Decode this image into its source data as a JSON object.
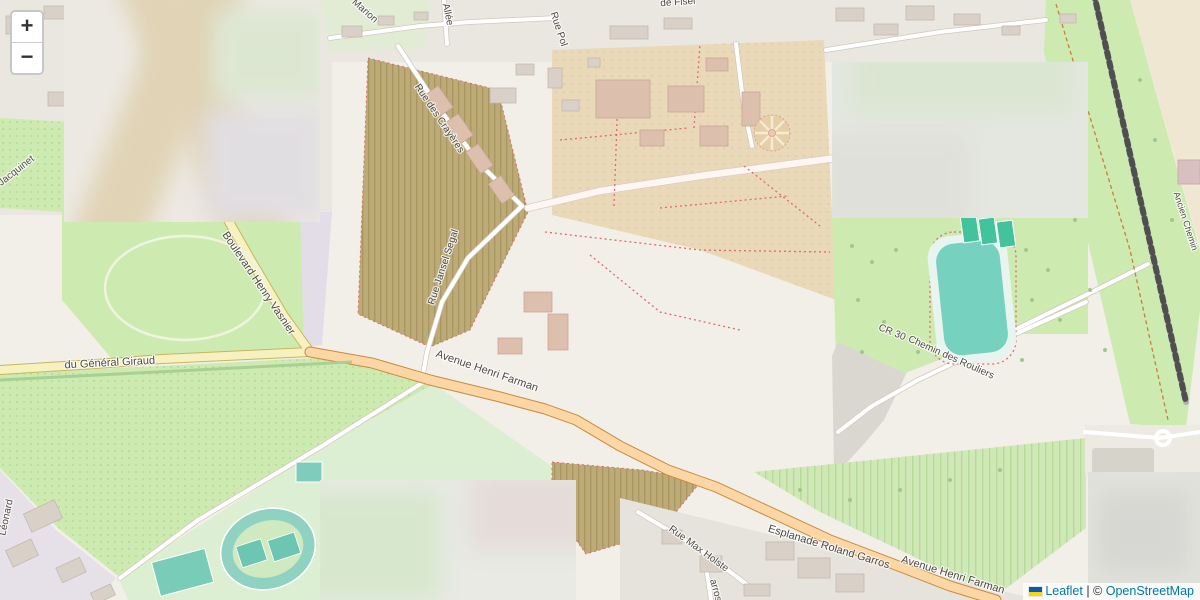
{
  "controls": {
    "zoom_in": "+",
    "zoom_out": "−"
  },
  "attribution": {
    "leaflet": "Leaflet",
    "separator": " | ",
    "copyright_prefix": "©",
    "osm": "OpenStreetMap"
  },
  "colors": {
    "street_label": "#4e4a43",
    "parking": "#3069c9",
    "boundary": "#2e4a8f",
    "water": "#76d2bf",
    "park_green": "#cdebb0",
    "road_primary": "#fcd6a4",
    "road_secondary": "#f7f1c0"
  },
  "overlay": {
    "points": "368,57 822,40 840,428 590,558 357,312",
    "fill": "#f0414f",
    "fill_opacity": 0.28,
    "stroke": "#6b3049",
    "stroke_width": 2
  },
  "boundaries": [
    {
      "points": "355,0 367,57"
    },
    {
      "points": "0,177 118,366 357,312"
    },
    {
      "points": "1199,8 1139,234 1200,255"
    }
  ],
  "map": {
    "street_labels": [
      {
        "text": "Marion",
        "x": 363,
        "y": 13,
        "rot": 42,
        "size": 10
      },
      {
        "text": "Allée",
        "x": 445,
        "y": 15,
        "rot": 78,
        "size": 10
      },
      {
        "text": "de Fisel",
        "x": 678,
        "y": 5,
        "rot": -4,
        "size": 10
      },
      {
        "text": "Rue Pol",
        "x": 556,
        "y": 30,
        "rot": 72,
        "size": 10
      },
      {
        "text": "Rue des Crayères",
        "x": 437,
        "y": 120,
        "rot": 56,
        "size": 10
      },
      {
        "text": "Rue Jansel Segal",
        "x": 446,
        "y": 268,
        "rot": -72,
        "size": 10
      },
      {
        "text": "Boulevard Henry Vasnier",
        "x": 256,
        "y": 285,
        "rot": 56,
        "size": 11
      },
      {
        "text": "du Général Giraud",
        "x": 110,
        "y": 366,
        "rot": -3,
        "size": 11
      },
      {
        "text": "Avenue Henri Farman",
        "x": 486,
        "y": 374,
        "rot": 19,
        "size": 11
      },
      {
        "text": "Esplanade Roland Garros",
        "x": 828,
        "y": 550,
        "rot": 17,
        "size": 11
      },
      {
        "text": "Avenue Henri Farman",
        "x": 952,
        "y": 578,
        "rot": 17,
        "size": 11
      },
      {
        "text": "Rue Max Holste",
        "x": 697,
        "y": 551,
        "rot": 36,
        "size": 10
      },
      {
        "text": "arros",
        "x": 713,
        "y": 591,
        "rot": 75,
        "size": 10
      },
      {
        "text": "Chemin des Rouliers",
        "x": 950,
        "y": 360,
        "rot": 24,
        "size": 10
      },
      {
        "text": "CR 30",
        "x": 891,
        "y": 335,
        "rot": 22,
        "size": 10
      },
      {
        "text": "Ancien Chemin",
        "x": 1183,
        "y": 222,
        "rot": 72,
        "size": 9
      },
      {
        "text": "Jacquinet",
        "x": 18,
        "y": 173,
        "rot": -38,
        "size": 10
      },
      {
        "text": "Léonard",
        "x": 9,
        "y": 518,
        "rot": -78,
        "size": 10
      }
    ],
    "place_labels": [
      {
        "lines": [
          "Parc des",
          "Crayères"
        ],
        "x": 127,
        "y": 272,
        "lh": 15,
        "color": "#5e7f5e",
        "italic": true,
        "size": 12
      },
      {
        "lines": [
          "Château",
          "des Crayères"
        ],
        "x": 215,
        "y": 348,
        "lh": 11,
        "color": "#8a684a",
        "italic": false,
        "size": 10
      },
      {
        "lines": [
          "Résidence",
          "Moulin",
          "de la Housse"
        ],
        "x": 440,
        "y": 72,
        "lh": 11.5,
        "color": "#5d5450",
        "italic": false,
        "size": 10
      },
      {
        "lines": [
          "Monument",
          "aux Sportifs",
          "Rémois"
        ],
        "x": 475,
        "y": 403,
        "lh": 13,
        "color": "#7b4a35",
        "italic": false,
        "size": 11
      },
      {
        "lines": [
          "Monument",
          "de guerre"
        ],
        "x": 503,
        "y": 461,
        "lh": 13,
        "color": "#7b4a35",
        "italic": false,
        "size": 11
      },
      {
        "lines": [
          "Aire de",
          "Grand",
          "Passage",
          "des Gens",
          "du Voyage",
          "du Moulin",
          "de la Housse"
        ],
        "x": 876,
        "y": 371,
        "lh": 16.5,
        "color": "#848484",
        "italic": true,
        "size": 11
      },
      {
        "lines": [
          "Centre",
          "en Route",
          "de la"
        ],
        "x": 1128,
        "y": 441,
        "lh": 14,
        "color": "#7d7d7d",
        "italic": false,
        "size": 11
      },
      {
        "lines": [
          "ESI Reims"
        ],
        "x": 806,
        "y": 575,
        "lh": 12,
        "color": "#8a8a8a",
        "italic": true,
        "size": 11
      },
      {
        "lines": [
          "Clos Pompadour"
        ],
        "x": 180,
        "y": 447,
        "lh": 12,
        "color": "#7f947f",
        "italic": true,
        "size": 12
      },
      {
        "lines": [
          "Ch"
        ],
        "x": 311,
        "y": 541,
        "lh": 12,
        "color": "#8a8a8a",
        "italic": true,
        "size": 12
      },
      {
        "lines": [
          "Terrain"
        ],
        "x": 218,
        "y": 598,
        "lh": 12,
        "color": "#8a8a8a",
        "italic": true,
        "size": 10
      }
    ],
    "parking": [
      {
        "x": 363,
        "y": 375
      },
      {
        "x": 464,
        "y": 322
      },
      {
        "x": 507,
        "y": 255
      },
      {
        "x": 515,
        "y": 363
      },
      {
        "x": 550,
        "y": 130,
        "size": 16
      },
      {
        "x": 594,
        "y": 197
      },
      {
        "x": 758,
        "y": 66,
        "size": 16
      },
      {
        "x": 930,
        "y": 244
      },
      {
        "x": 1140,
        "y": 399
      }
    ],
    "shields": [
      {
        "text": "N 44",
        "x": 293,
        "y": 351
      },
      {
        "text": "N 44",
        "x": 732,
        "y": 488
      }
    ],
    "arrows": [
      {
        "dir": "→",
        "x": 168,
        "y": 364,
        "rot": 0
      },
      {
        "dir": "←",
        "x": 318,
        "y": 355,
        "rot": 0
      },
      {
        "dir": "→",
        "x": 367,
        "y": 355,
        "rot": 0
      },
      {
        "dir": "→",
        "x": 537,
        "y": 404,
        "rot": 20
      },
      {
        "dir": "←",
        "x": 780,
        "y": 514,
        "rot": 17
      },
      {
        "dir": "→",
        "x": 797,
        "y": 524,
        "rot": 17
      },
      {
        "dir": "←",
        "x": 874,
        "y": 556,
        "rot": 17
      }
    ],
    "blue_squares": [
      {
        "x": 401,
        "y": 52
      },
      {
        "x": 404,
        "y": 96
      },
      {
        "x": 428,
        "y": 308
      },
      {
        "x": 506,
        "y": 217
      },
      {
        "x": 355,
        "y": 356
      }
    ],
    "monuments": [
      {
        "x": 472,
        "y": 392,
        "color": "#8c3b2e"
      },
      {
        "x": 507,
        "y": 427,
        "color": "#8c3b2e"
      },
      {
        "x": 504,
        "y": 446,
        "color": "#8c3b2e"
      },
      {
        "x": 648,
        "y": 183,
        "color": "#555049"
      },
      {
        "x": 770,
        "y": 157,
        "color": "#555049"
      }
    ],
    "castle": {
      "x": 215,
      "y": 332,
      "color": "#8a6948"
    }
  }
}
